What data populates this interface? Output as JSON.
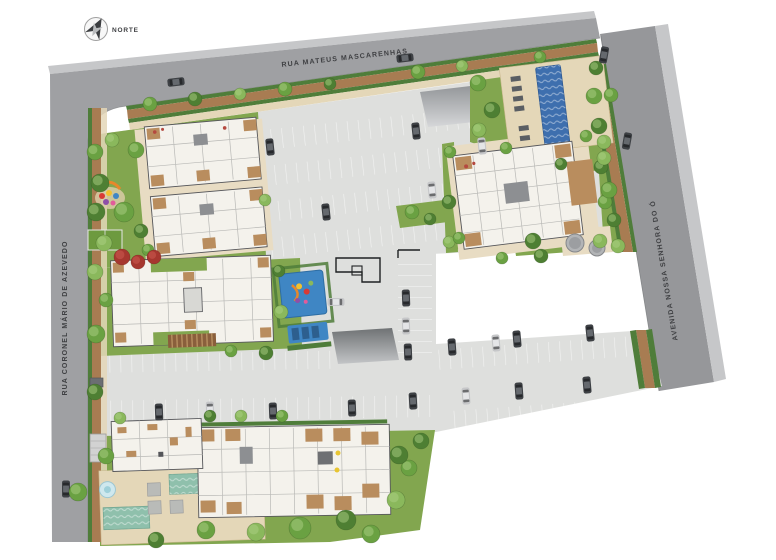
{
  "meta": {
    "drawing_type": "residential site plan (implantacao)"
  },
  "labels": {
    "north": "NORTE",
    "street_top": "RUA MATEUS MASCARENHAS",
    "street_left": "RUA CORONEL MÁRIO DE AZEVEDO",
    "street_right": "AVENIDA NOSSA SENHORA DO Ó"
  },
  "palette": {
    "asphalt": "#9fa0a3",
    "asphalt_dark": "#96979a",
    "sidewalk_out": "#c6c7c9",
    "curb": "#7b7d7f",
    "walk_brown": "#a87c52",
    "walk_brown_dark": "#8a5f3c",
    "hedge": "#4f7d3a",
    "lawn": "#82a64f",
    "lawn_dark": "#6d9a3f",
    "pavement": "#dedfdd",
    "pavement_dark": "#d2d3d2",
    "plaza": "#e8dcc3",
    "deck": "#e4d7b8",
    "building": "#f4f2ec",
    "wall": "#55565a",
    "wall_dark": "#222326",
    "roomline": "#b9b9b6",
    "wood": "#b98d5e",
    "pool_blue": "#3e6fae",
    "pool_teal": "#8fc0ac",
    "fountain": "#cfe8ee",
    "mat_blue": "#3f86c4",
    "tree_a": "#4e7f33",
    "tree_b": "#6aa142",
    "tree_c": "#8ab85c",
    "tree_hi": "#abd083",
    "red_tree": "#a6372f",
    "red_tree_hi": "#c9574e",
    "car_dark": "#3e4145",
    "car_dark_roof": "#65696e",
    "car_silver": "#c6c7c9",
    "car_silver_roof": "#e4e5e7",
    "text": "#3f4043"
  },
  "features": {
    "trees": [
      [
        150,
        104,
        7,
        1
      ],
      [
        195,
        99,
        7,
        0
      ],
      [
        240,
        94,
        6,
        2
      ],
      [
        285,
        89,
        7,
        1
      ],
      [
        330,
        84,
        6,
        0
      ],
      [
        418,
        72,
        7,
        1
      ],
      [
        462,
        66,
        6,
        2
      ],
      [
        540,
        57,
        6,
        1
      ],
      [
        95,
        152,
        8,
        1
      ],
      [
        96,
        212,
        9,
        0
      ],
      [
        95,
        272,
        8,
        2
      ],
      [
        96,
        334,
        9,
        1
      ],
      [
        95,
        392,
        8,
        0
      ],
      [
        78,
        492,
        9,
        1
      ],
      [
        112,
        140,
        7,
        2
      ],
      [
        136,
        150,
        8,
        1
      ],
      [
        100,
        183,
        9,
        0
      ],
      [
        124,
        212,
        10,
        1
      ],
      [
        104,
        243,
        8,
        2
      ],
      [
        141,
        231,
        7,
        0
      ],
      [
        148,
        250,
        6,
        1
      ],
      [
        265,
        200,
        6,
        2
      ],
      [
        412,
        212,
        7,
        1
      ],
      [
        430,
        219,
        6,
        0
      ],
      [
        478,
        83,
        8,
        1
      ],
      [
        492,
        110,
        8,
        0
      ],
      [
        479,
        130,
        7,
        2
      ],
      [
        506,
        148,
        6,
        1
      ],
      [
        596,
        68,
        7,
        0
      ],
      [
        611,
        95,
        7,
        1
      ],
      [
        604,
        142,
        7,
        2
      ],
      [
        561,
        164,
        6,
        0
      ],
      [
        450,
        152,
        6,
        1
      ],
      [
        449,
        202,
        7,
        0
      ],
      [
        449,
        242,
        6,
        2
      ],
      [
        586,
        136,
        6,
        1
      ],
      [
        601,
        167,
        7,
        0
      ],
      [
        605,
        202,
        7,
        1
      ],
      [
        600,
        241,
        7,
        2
      ],
      [
        541,
        256,
        7,
        0
      ],
      [
        502,
        258,
        6,
        1
      ],
      [
        594,
        96,
        8,
        1
      ],
      [
        599,
        126,
        8,
        0
      ],
      [
        604,
        158,
        7,
        2
      ],
      [
        609,
        190,
        8,
        1
      ],
      [
        614,
        220,
        7,
        0
      ],
      [
        618,
        246,
        7,
        2
      ],
      [
        106,
        300,
        7,
        1
      ],
      [
        279,
        271,
        6,
        0
      ],
      [
        281,
        312,
        7,
        2
      ],
      [
        231,
        351,
        6,
        1
      ],
      [
        266,
        353,
        7,
        0
      ],
      [
        459,
        238,
        6,
        1
      ],
      [
        533,
        241,
        8,
        0
      ],
      [
        106,
        456,
        8,
        1
      ],
      [
        210,
        416,
        6,
        0
      ],
      [
        241,
        416,
        6,
        2
      ],
      [
        282,
        416,
        6,
        1
      ],
      [
        120,
        418,
        6,
        2
      ],
      [
        300,
        528,
        11,
        1
      ],
      [
        346,
        520,
        10,
        0
      ],
      [
        256,
        532,
        9,
        2
      ],
      [
        206,
        530,
        9,
        1
      ],
      [
        156,
        540,
        8,
        0
      ],
      [
        371,
        534,
        9,
        1
      ],
      [
        396,
        500,
        9,
        2
      ],
      [
        409,
        468,
        8,
        1
      ],
      [
        421,
        441,
        8,
        0
      ],
      [
        399,
        455,
        9,
        0
      ]
    ],
    "red_trees": [
      [
        122,
        257,
        8
      ],
      [
        138,
        262,
        7
      ],
      [
        154,
        257,
        7
      ]
    ],
    "tanks": [
      [
        575,
        243,
        9
      ],
      [
        597,
        248,
        8
      ]
    ],
    "cars": [
      [
        176,
        82,
        -7,
        "d"
      ],
      [
        405,
        58,
        -7,
        "d"
      ],
      [
        604,
        55,
        100,
        "d"
      ],
      [
        627,
        141,
        100,
        "d"
      ],
      [
        66,
        489,
        90,
        "d"
      ],
      [
        270,
        147,
        84,
        "d"
      ],
      [
        416,
        131,
        84,
        "d"
      ],
      [
        432,
        190,
        84,
        "s"
      ],
      [
        326,
        212,
        84,
        "d"
      ],
      [
        482,
        146,
        84,
        "s"
      ],
      [
        406,
        298,
        88,
        "d"
      ],
      [
        406,
        326,
        88,
        "s"
      ],
      [
        408,
        352,
        88,
        "d"
      ],
      [
        336,
        302,
        0,
        "s"
      ],
      [
        159,
        412,
        88,
        "d"
      ],
      [
        210,
        410,
        88,
        "s"
      ],
      [
        273,
        411,
        88,
        "d"
      ],
      [
        352,
        408,
        88,
        "d"
      ],
      [
        452,
        347,
        86,
        "d"
      ],
      [
        496,
        343,
        85,
        "s"
      ],
      [
        517,
        339,
        85,
        "d"
      ],
      [
        590,
        333,
        84,
        "d"
      ],
      [
        413,
        401,
        87,
        "d"
      ],
      [
        466,
        396,
        86,
        "s"
      ],
      [
        519,
        391,
        86,
        "d"
      ],
      [
        587,
        385,
        85,
        "d"
      ]
    ]
  }
}
